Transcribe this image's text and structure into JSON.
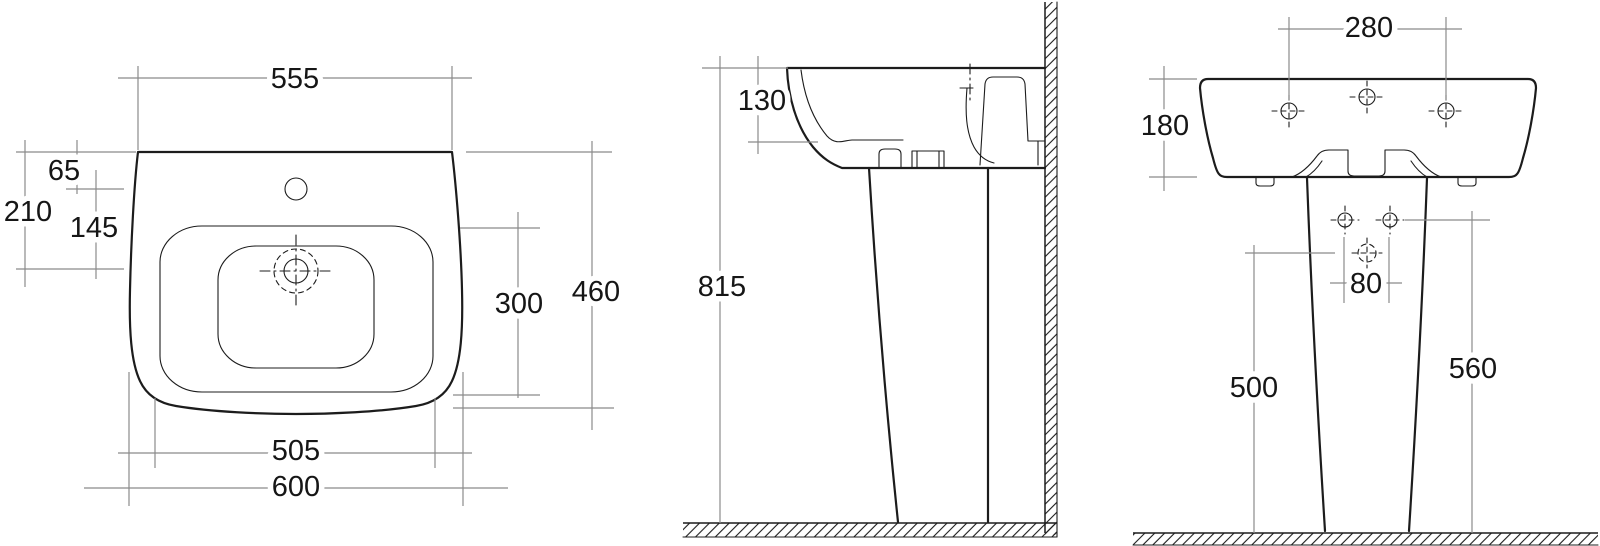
{
  "drawing": {
    "title": "Pedestal washbasin dimensional drawing",
    "views": {
      "plan": {
        "dims": {
          "top_width": "555",
          "tap_hole_offset": "65",
          "drain_offset": "210",
          "tap_to_drain": "145",
          "bowl_length": "300",
          "overall_depth": "460",
          "inner_width": "505",
          "overall_width": "600"
        }
      },
      "side": {
        "dims": {
          "rim_depth": "130",
          "total_height": "815"
        }
      },
      "front": {
        "dims": {
          "tap_hole_spacing": "280",
          "basin_height": "180",
          "fixing_hole_spacing": "80",
          "pedestal_front_height": "500",
          "pedestal_back_height": "560"
        }
      }
    },
    "colors": {
      "drawing_line": "#1c1c1c",
      "dimension_line": "#8b8b8b",
      "background": "#ffffff",
      "label_text": "#161616"
    }
  }
}
